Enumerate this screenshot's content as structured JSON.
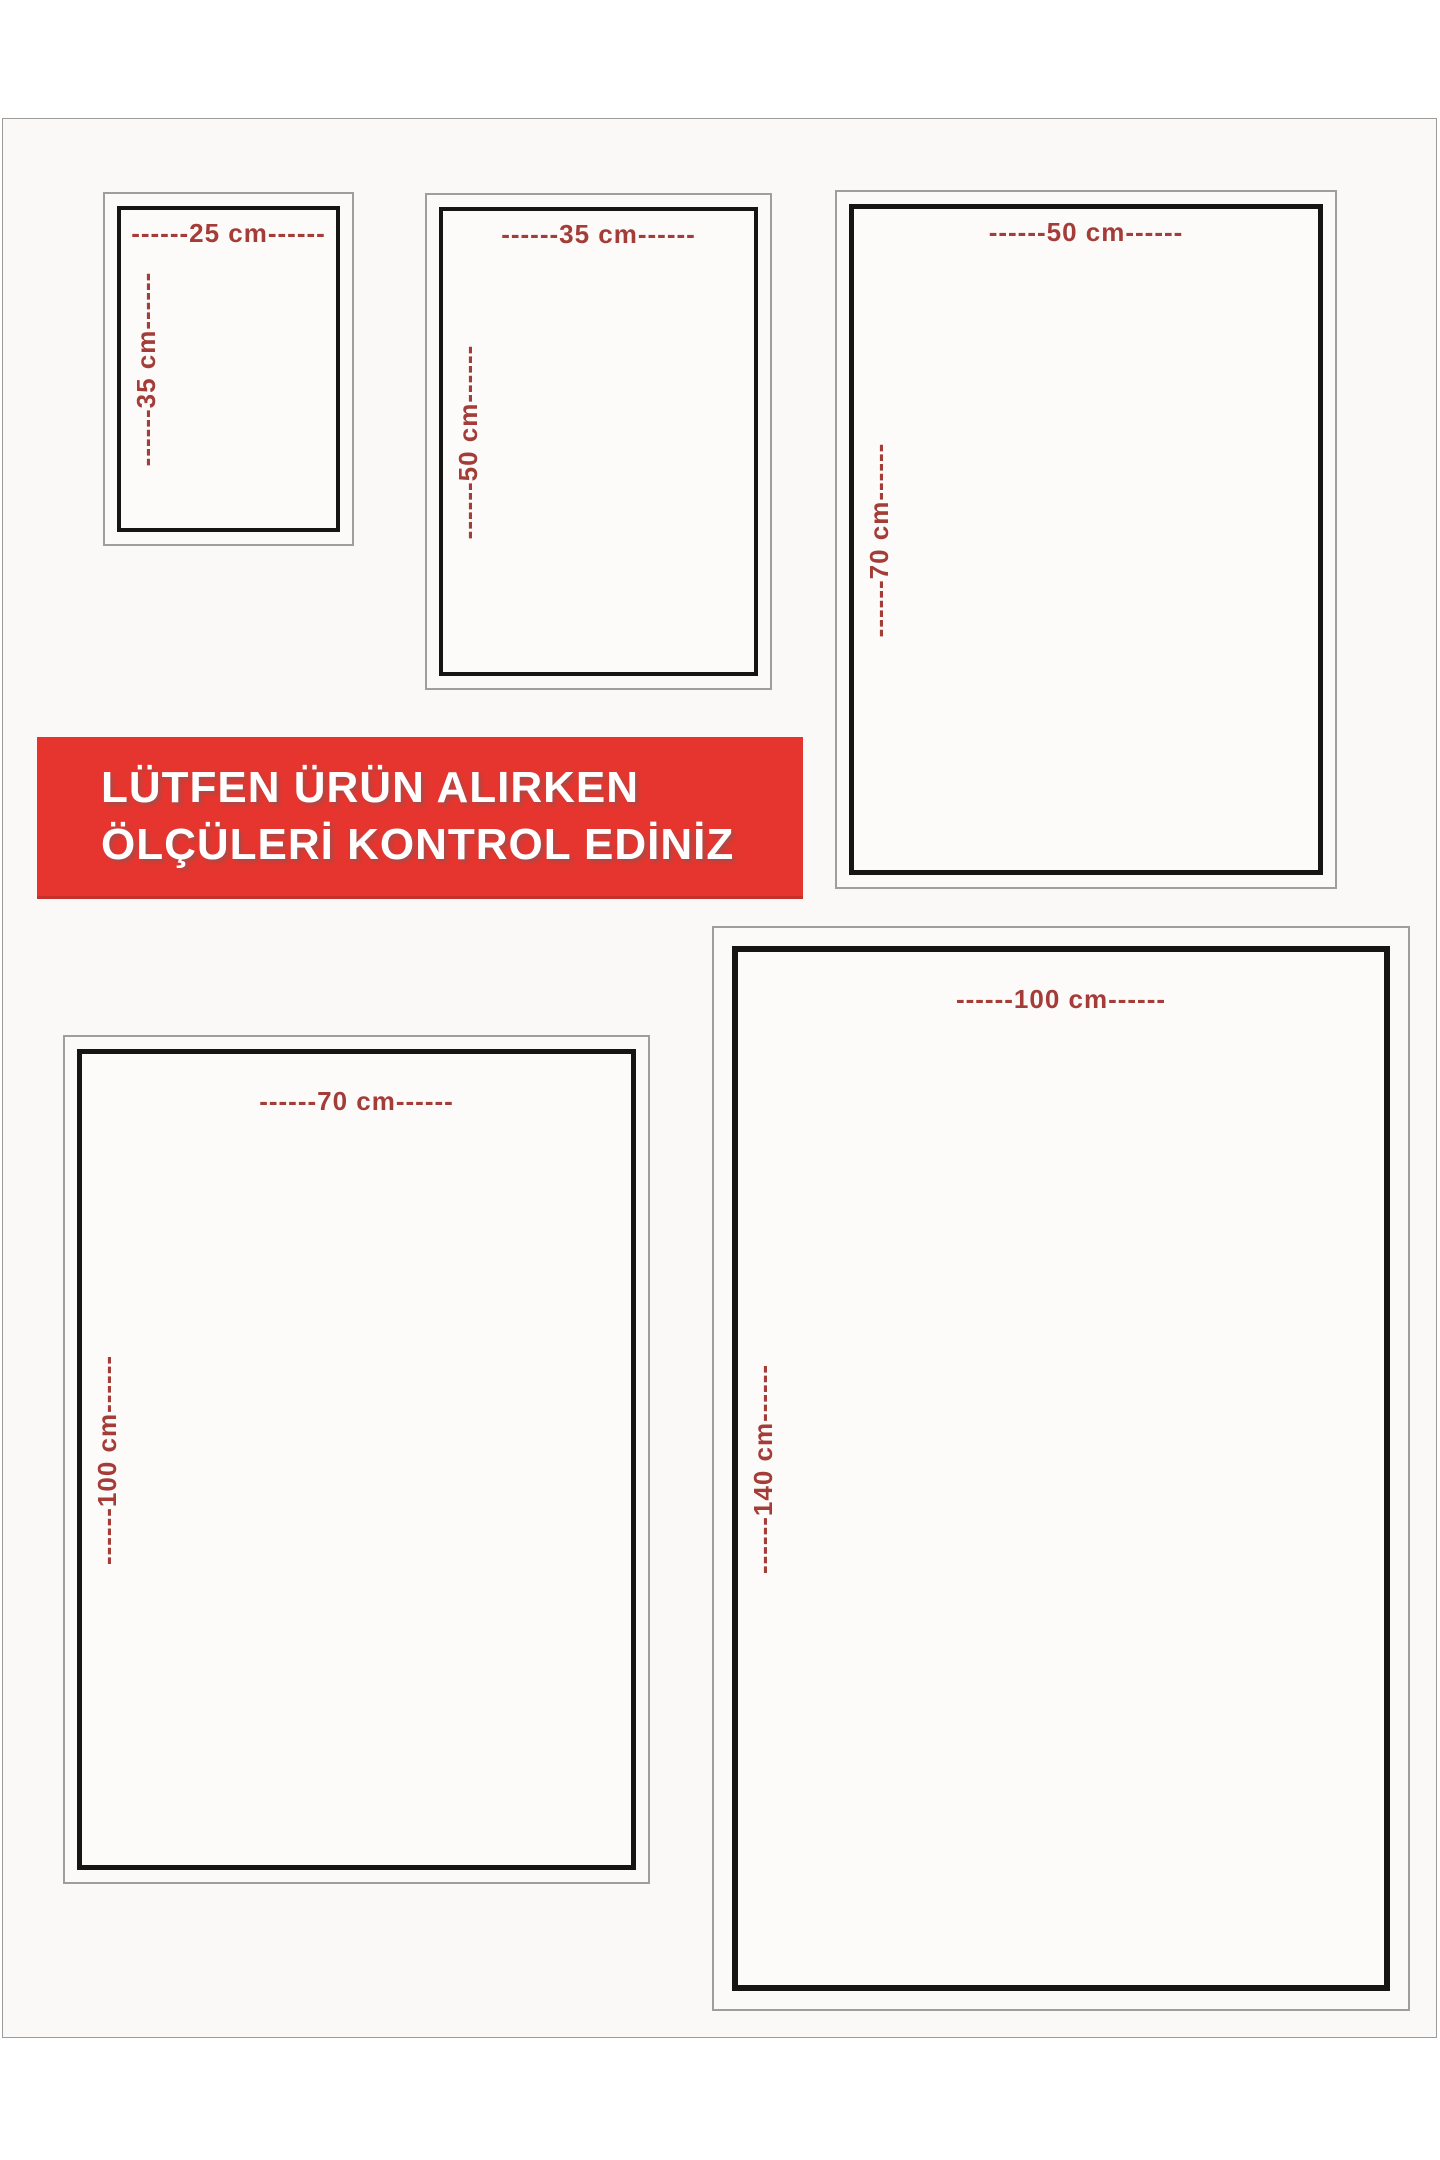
{
  "banner": {
    "line1": "LÜTFEN ÜRÜN ALIRKEN",
    "line2": "ÖLÇÜLERİ KONTROL EDİNİZ"
  },
  "sizes": [
    {
      "name": "25x35 cm",
      "width_label": "------25 cm------",
      "height_label": "------35 cm------"
    },
    {
      "name": "35x50 cm",
      "width_label": "------35 cm------",
      "height_label": "------50 cm------"
    },
    {
      "name": "50x70 cm",
      "width_label": "------50 cm------",
      "height_label": "------70 cm------"
    },
    {
      "name": "70x100 cm",
      "width_label": "------70 cm------",
      "height_label": "------100 cm------"
    },
    {
      "name": "100x140 cm",
      "width_label": "------100 cm------",
      "height_label": "------140 cm------"
    }
  ],
  "colors": {
    "banner_background": "#e6352f",
    "banner_text": "#ffffff",
    "dimension_label": "#a43c38",
    "box_border": "#151515",
    "frame_border": "#9e9e9e",
    "page_background": "#faf9f8"
  }
}
